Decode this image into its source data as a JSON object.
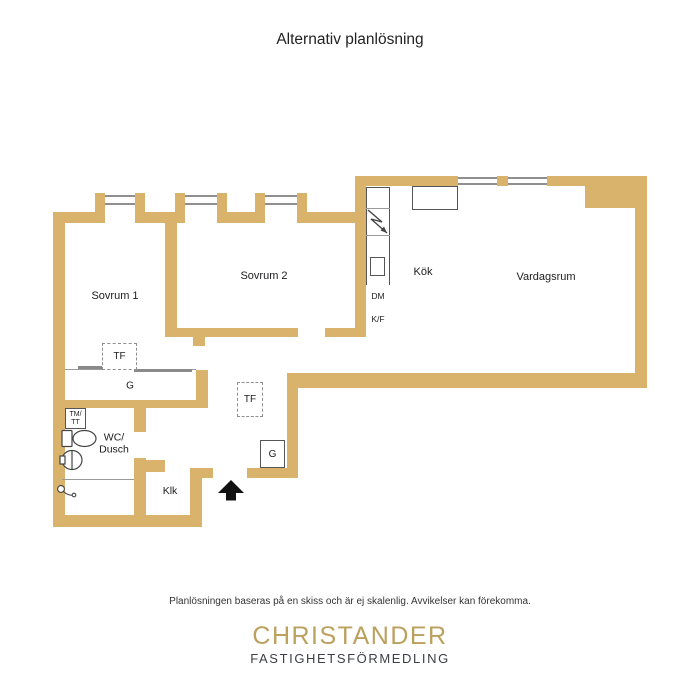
{
  "title": "Alternativ planlösning",
  "footer": {
    "disclaimer": "Planlösningen baseras på en skiss och är ej skalenlig. Avvikelser kan förekomma."
  },
  "branding": {
    "name": "CHRISTANDER",
    "tagline": "FASTIGHETSFÖRMEDLING",
    "name_color": "#bca05e",
    "tagline_color": "#3c4046"
  },
  "colors": {
    "wall": "#d9b26b",
    "window_line": "#8f8f8f",
    "fixture_line": "#555555",
    "text": "#1d1d1f"
  },
  "labels": {
    "sovrum1": "Sovrum 1",
    "sovrum2": "Sovrum 2",
    "kok": "Kök",
    "vardagsrum": "Vardagsrum",
    "wc_dusch_line1": "WC/",
    "wc_dusch_line2": "Dusch",
    "klk": "Klk",
    "tf": "TF",
    "garderob": "G",
    "tm_tt_line1": "TM/",
    "tm_tt_line2": "TT",
    "dm": "DM",
    "kf": "K/F"
  }
}
